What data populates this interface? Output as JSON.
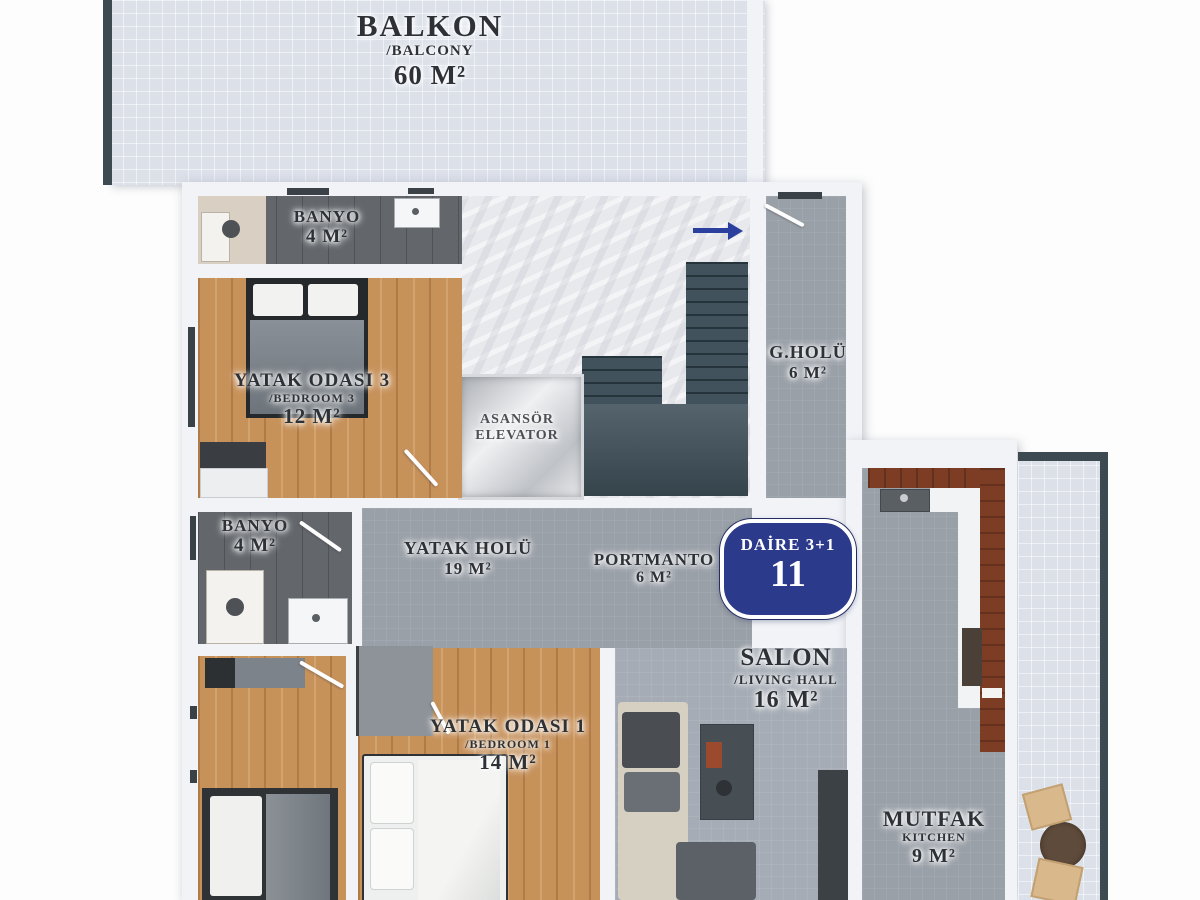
{
  "badge": {
    "line1": "DAİRE 3+1",
    "line2": "11"
  },
  "rooms": {
    "balkon": {
      "name": "BALKON",
      "alt": "/BALCONY",
      "area": "60 M²"
    },
    "banyo_top": {
      "name": "BANYO",
      "area": "4 M²"
    },
    "yatak3": {
      "name": "YATAK ODASI 3",
      "alt": "/BEDROOM 3",
      "area": "12 M²"
    },
    "asansor": {
      "name": "ASANSÖR",
      "alt": "ELEVATOR"
    },
    "g_holu": {
      "name": "G.HOLÜ",
      "area": "6 M²"
    },
    "banyo_mid": {
      "name": "BANYO",
      "area": "4 M²"
    },
    "yatak_holu": {
      "name": "YATAK HOLÜ",
      "area": "19 M²"
    },
    "portmanto": {
      "name": "PORTMANTO",
      "area": "6 M²"
    },
    "salon": {
      "name": "SALON",
      "alt": "/LIVING HALL",
      "area": "16 M²"
    },
    "yatak1": {
      "name": "YATAK ODASI 1",
      "alt": "/BEDROOM 1",
      "area": "14 M²"
    },
    "mutfak": {
      "name": "MUTFAK",
      "alt": "KITCHEN",
      "area": "9 M²"
    }
  },
  "icons": {
    "direction_arrow": "right-arrow",
    "stairs": "staircase",
    "elevator_shaft": "elevator"
  },
  "colors": {
    "badge_blue": "#2c3a8c",
    "arrow_blue": "#2b3f9e",
    "wood_floor": "#c7915a",
    "hall_gray": "#9aa0a8",
    "bath_dark": "#63676c",
    "balcony_tile": "#dbe0e9",
    "stairs_dark": "#41525c",
    "cabinet_brown": "#7c3d24",
    "label_ink": "#2e3237"
  }
}
